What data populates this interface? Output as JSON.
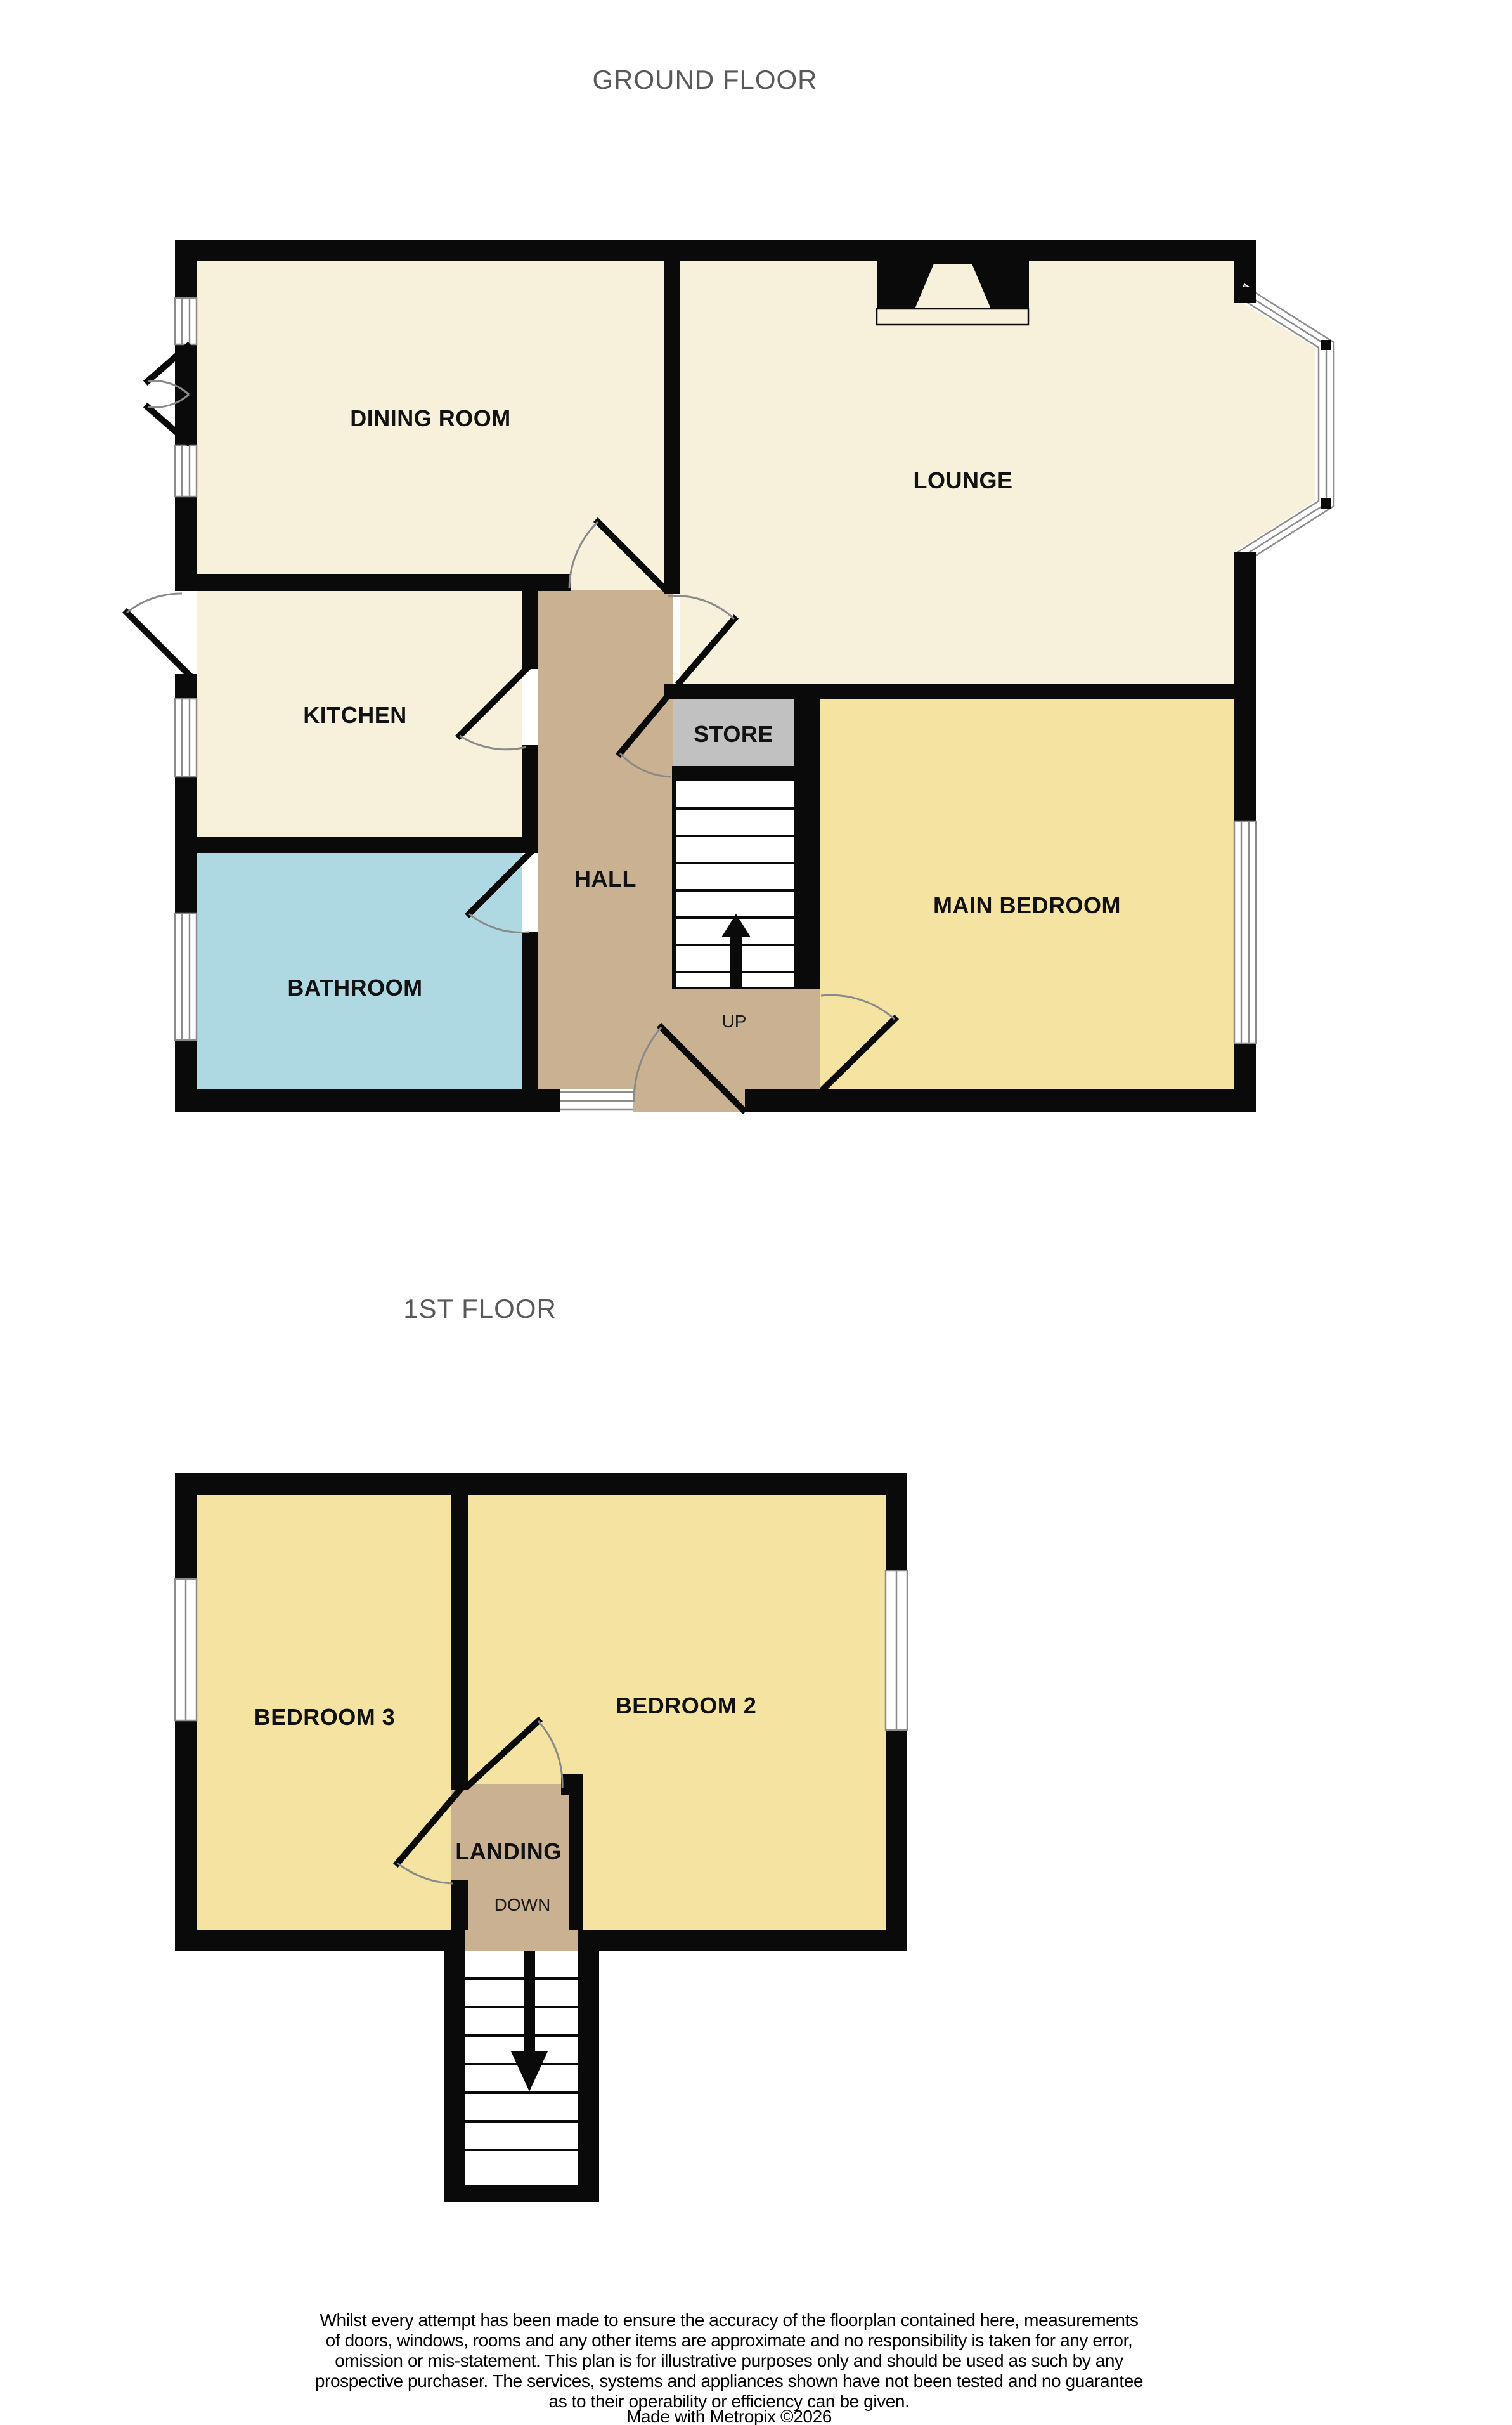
{
  "titles": {
    "ground_floor": "GROUND FLOOR",
    "first_floor": "1ST FLOOR"
  },
  "ground_floor": {
    "labels": {
      "dining": "DINING ROOM",
      "lounge": "LOUNGE",
      "kitchen": "KITCHEN",
      "store": "STORE",
      "hall": "HALL",
      "main_bedroom": "MAIN BEDROOM",
      "bathroom": "BATHROOM",
      "stairs_direction": "UP"
    }
  },
  "first_floor": {
    "labels": {
      "bedroom3": "BEDROOM 3",
      "bedroom2": "BEDROOM 2",
      "landing": "LANDING",
      "stairs_direction": "DOWN"
    }
  },
  "colors": {
    "wall": "#0A0A0A",
    "room_cream": "#F7F1DC",
    "room_yellow": "#F5E3A2",
    "hall_tan": "#C9B192",
    "bathroom_blue": "#AFD9E2",
    "store_grey": "#C2C1C1",
    "title_grey": "#58595B"
  },
  "disclaimer": {
    "lines": [
      "Whilst every attempt has been made to ensure the accuracy of the floorplan contained here, measurements",
      "of doors, windows, rooms and any other items are approximate and no responsibility is taken for any error,",
      "omission or mis-statement. This plan is for illustrative purposes only and should be used as such by any",
      "prospective purchaser. The services, systems and appliances shown have not been tested and no guarantee",
      "as to their operability or efficiency can be given."
    ],
    "credit": "Made with Metropix ©2026"
  }
}
